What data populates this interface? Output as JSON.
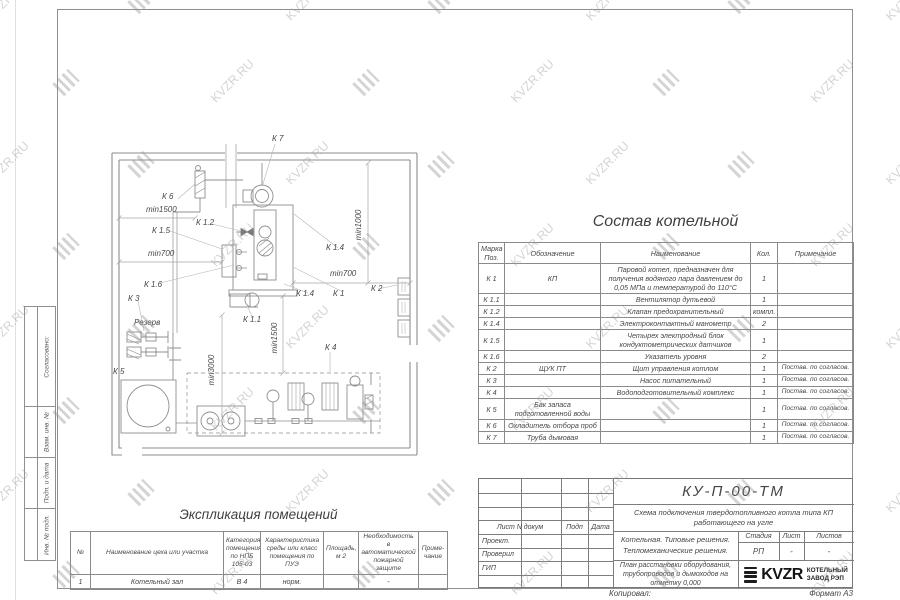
{
  "watermark": {
    "text": "KVZR.RU"
  },
  "plan": {
    "labels": {
      "k7": "К 7",
      "k6": "К 6",
      "min1500a": "min1500",
      "k15": "К 1.5",
      "k12": "К 1.2",
      "min700a": "min700",
      "k16": "К 1.6",
      "k3": "К 3",
      "rezerv": "Резерв",
      "k5": "К 5",
      "k11": "К 1.1",
      "min3000": "min3000",
      "min1500b": "min1500",
      "k4": "К 4",
      "k14a": "К 1.4",
      "k14b": "К 1.4",
      "min700b": "min700",
      "k1": "К 1",
      "k2": "К 2",
      "min1000": "min1000"
    }
  },
  "sostav": {
    "title": "Состав котельной",
    "headers": {
      "pos": "Марка Поз.",
      "oboz": "Обозначение",
      "name": "Наименование",
      "qty": "Кол.",
      "note": "Примечание"
    },
    "rows": [
      {
        "pos": "К 1",
        "oboz": "КП",
        "name": "Паровой котел, предназначен для получения водяного пара давлением до 0,05 МПа и температурой до 110°С",
        "qty": "1",
        "note": ""
      },
      {
        "pos": "К 1.1",
        "oboz": "",
        "name": "Вентилятор дутьевой",
        "qty": "1",
        "note": ""
      },
      {
        "pos": "К 1.2",
        "oboz": "",
        "name": "Клапан предохранительный",
        "qty": "компл.",
        "note": ""
      },
      {
        "pos": "К 1.4",
        "oboz": "",
        "name": "Электроконтактный манометр",
        "qty": "2",
        "note": ""
      },
      {
        "pos": "К 1.5",
        "oboz": "",
        "name": "Четырех электродный блок кондуктометрических датчиков",
        "qty": "1",
        "note": ""
      },
      {
        "pos": "К 1.6",
        "oboz": "",
        "name": "Указатель уровня",
        "qty": "2",
        "note": ""
      },
      {
        "pos": "К 2",
        "oboz": "ЩУК ПТ",
        "name": "Щит управления котлом",
        "qty": "1",
        "note": "Постав. по согласов."
      },
      {
        "pos": "К 3",
        "oboz": "",
        "name": "Насос питательный",
        "qty": "1",
        "note": "Постав. по согласов."
      },
      {
        "pos": "К 4",
        "oboz": "",
        "name": "Водоподготовительный комплекс",
        "qty": "1",
        "note": "Постав. по согласов."
      },
      {
        "pos": "К 5",
        "oboz": "Бак запаса подготовленной воды",
        "name": "",
        "qty": "1",
        "note": "Постав. по согласов."
      },
      {
        "pos": "К 6",
        "oboz": "Охладитель отбора проб",
        "name": "",
        "qty": "1",
        "note": "Постав. по согласов."
      },
      {
        "pos": "К 7",
        "oboz": "Труба дымовая",
        "name": "",
        "qty": "1",
        "note": "Постав. по согласов."
      }
    ]
  },
  "expl": {
    "title": "Экспликация помещений",
    "headers": [
      "№",
      "Наименование цеха или участка",
      "Категория помещения по НПБ 105-03",
      "Характеристика среды или класс помещения по ПУЭ",
      "Площадь, м 2",
      "Необходимость в автоматической пожарной защите",
      "Приме-чание"
    ],
    "row": [
      "1",
      "Котельный зал",
      "В 4",
      "норм.",
      "",
      "-",
      ""
    ]
  },
  "titleblock": {
    "doc_number": "КУ-П-00-ТМ",
    "subtitle": "Схема подключения твердотопливного котла типа КП работающего на угле",
    "object": "Котельная. Типовые решения. Тепломеханические решения.",
    "sheet_name": "План расстановки оборудования, трубопроводов и дымоходов на отметку 0,000",
    "cols": {
      "doc": "Лист N докум",
      "sign": "Подп",
      "date": "Дата"
    },
    "roles": {
      "r1": "Проект.",
      "r2": "Проверил",
      "r3": "ГИП"
    },
    "stage_label": "Стадия",
    "sheet_label": "Лист",
    "sheets_label": "Листов",
    "stage": "РП",
    "sheet": "-",
    "sheets": "-",
    "company": {
      "logo": "KVZR",
      "name1": "КОТЕЛЬНЫЙ",
      "name2": "ЗАВОД РЭП"
    }
  },
  "margin": {
    "agreed": "Согласовано:",
    "vzam": "Взам. инв. №",
    "podp": "Подп. и дата",
    "inv": "Инв. № подл."
  },
  "footer": {
    "copied": "Копировал:",
    "format": "Формат А3"
  }
}
